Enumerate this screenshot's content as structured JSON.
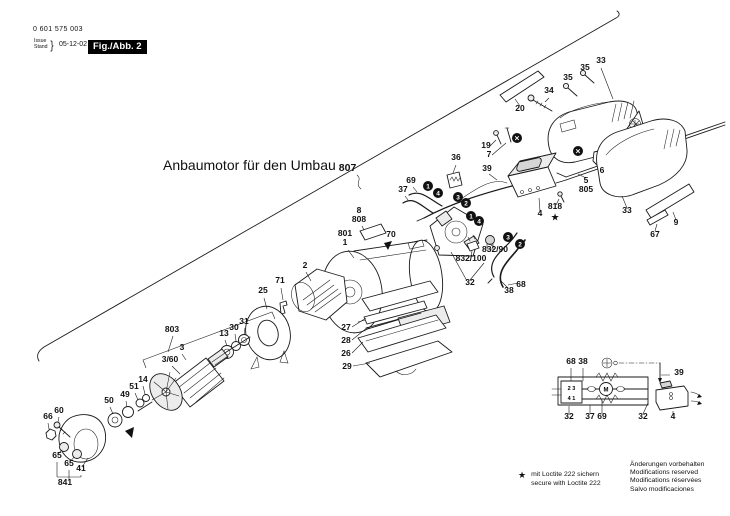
{
  "header": {
    "part_number": "0 601 575 003",
    "issue_label": "Issue",
    "stand_label": "Stand",
    "brace": "}",
    "date": "05-12-02",
    "figure": "Fig./Abb. 2"
  },
  "title": {
    "text": "Anbaumotor für den Umbau",
    "ref": "807"
  },
  "footnote": {
    "star": "★",
    "line1": "mit Loctite 222 sichern",
    "line2": "secure with Loctite 222"
  },
  "notices": [
    "Änderungen vorbehalten",
    "Modifications reserved",
    "Modifications réservées",
    "Salvo modificaciones"
  ],
  "diagram": {
    "part_labels": [
      {
        "t": "20",
        "x": 520,
        "y": 111
      },
      {
        "t": "34",
        "x": 549,
        "y": 93
      },
      {
        "t": "35",
        "x": 568,
        "y": 80
      },
      {
        "t": "35",
        "x": 585,
        "y": 70
      },
      {
        "t": "33",
        "x": 601,
        "y": 63
      },
      {
        "t": "19",
        "x": 486,
        "y": 148
      },
      {
        "t": "7",
        "x": 489,
        "y": 157
      },
      {
        "t": "39",
        "x": 487,
        "y": 171
      },
      {
        "t": "36",
        "x": 456,
        "y": 160
      },
      {
        "t": "69",
        "x": 411,
        "y": 183
      },
      {
        "t": "37",
        "x": 403,
        "y": 192
      },
      {
        "t": "5",
        "x": 586,
        "y": 183
      },
      {
        "t": "805",
        "x": 586,
        "y": 192
      },
      {
        "t": "6",
        "x": 602,
        "y": 173
      },
      {
        "t": "33",
        "x": 627,
        "y": 213
      },
      {
        "t": "9",
        "x": 676,
        "y": 225
      },
      {
        "t": "67",
        "x": 655,
        "y": 237
      },
      {
        "t": "4",
        "x": 540,
        "y": 216
      },
      {
        "t": "818",
        "x": 555,
        "y": 209
      },
      {
        "t": "★",
        "x": 555,
        "y": 220
      },
      {
        "t": "8",
        "x": 359,
        "y": 213
      },
      {
        "t": "808",
        "x": 359,
        "y": 222
      },
      {
        "t": "801",
        "x": 345,
        "y": 236
      },
      {
        "t": "1",
        "x": 345,
        "y": 245
      },
      {
        "t": "70",
        "x": 391,
        "y": 237
      },
      {
        "t": "832/90",
        "x": 495,
        "y": 252
      },
      {
        "t": "832/100",
        "x": 471,
        "y": 261
      },
      {
        "t": "32",
        "x": 470,
        "y": 285
      },
      {
        "t": "38",
        "x": 509,
        "y": 293
      },
      {
        "t": "68",
        "x": 521,
        "y": 287
      },
      {
        "t": "2",
        "x": 305,
        "y": 268
      },
      {
        "t": "71",
        "x": 280,
        "y": 283
      },
      {
        "t": "25",
        "x": 263,
        "y": 293
      },
      {
        "t": "31",
        "x": 244,
        "y": 324
      },
      {
        "t": "30",
        "x": 234,
        "y": 330
      },
      {
        "t": "13",
        "x": 224,
        "y": 336
      },
      {
        "t": "803",
        "x": 172,
        "y": 332
      },
      {
        "t": "3",
        "x": 182,
        "y": 350
      },
      {
        "t": "3/60",
        "x": 170,
        "y": 362
      },
      {
        "t": "14",
        "x": 143,
        "y": 382
      },
      {
        "t": "51",
        "x": 134,
        "y": 389
      },
      {
        "t": "49",
        "x": 125,
        "y": 397
      },
      {
        "t": "50",
        "x": 109,
        "y": 403
      },
      {
        "t": "60",
        "x": 59,
        "y": 413
      },
      {
        "t": "66",
        "x": 48,
        "y": 419
      },
      {
        "t": "65",
        "x": 57,
        "y": 458
      },
      {
        "t": "65",
        "x": 69,
        "y": 466
      },
      {
        "t": "41",
        "x": 81,
        "y": 471
      },
      {
        "t": "841",
        "x": 65,
        "y": 485
      },
      {
        "t": "27",
        "x": 346,
        "y": 330
      },
      {
        "t": "28",
        "x": 346,
        "y": 343
      },
      {
        "t": "26",
        "x": 346,
        "y": 356
      },
      {
        "t": "29",
        "x": 347,
        "y": 369
      }
    ],
    "connection_markers": [
      {
        "n": "1",
        "x": 428,
        "y": 186
      },
      {
        "n": "4",
        "x": 438,
        "y": 193
      },
      {
        "n": "3",
        "x": 458,
        "y": 197
      },
      {
        "n": "2",
        "x": 466,
        "y": 203
      },
      {
        "n": "1",
        "x": 471,
        "y": 216
      },
      {
        "n": "4",
        "x": 479,
        "y": 221
      },
      {
        "n": "3",
        "x": 508,
        "y": 237
      },
      {
        "n": "2",
        "x": 520,
        "y": 244
      }
    ],
    "assembly_markers": [
      {
        "x": 517,
        "y": 138
      },
      {
        "x": 578,
        "y": 151
      }
    ]
  },
  "schematic": {
    "connector_top": "2 3",
    "connector_bottom": "4 1",
    "motor": "M",
    "labels": [
      {
        "t": "68",
        "x": 571,
        "y": 364
      },
      {
        "t": "38",
        "x": 583,
        "y": 364
      },
      {
        "t": "39",
        "x": 679,
        "y": 375
      },
      {
        "t": "32",
        "x": 569,
        "y": 419
      },
      {
        "t": "37",
        "x": 590,
        "y": 419
      },
      {
        "t": "69",
        "x": 602,
        "y": 419
      },
      {
        "t": "32",
        "x": 643,
        "y": 419
      },
      {
        "t": "4",
        "x": 673,
        "y": 419
      }
    ]
  }
}
